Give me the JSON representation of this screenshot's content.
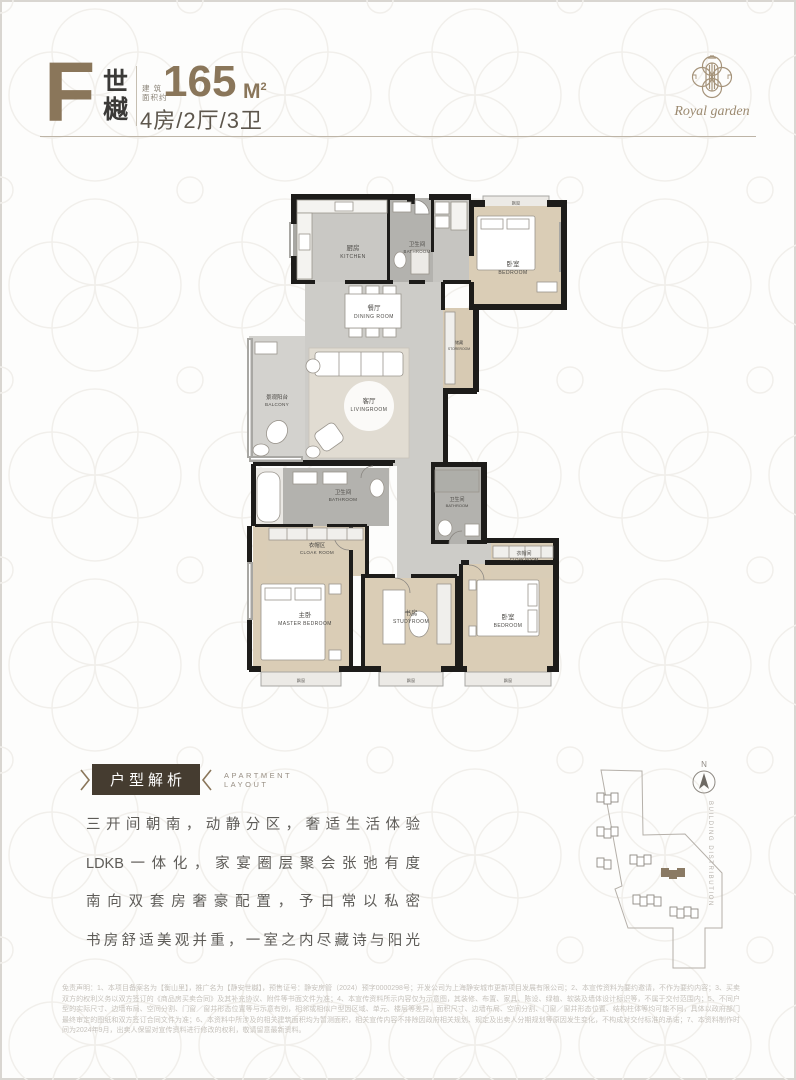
{
  "colors": {
    "accent_brown": "#8a765a",
    "badge_brown": "#453c30",
    "wall_black": "#1d1c1a",
    "floor_gray": "#cdccc8",
    "floor_tan": "#dacdb6",
    "floor_bath": "#b3b2ae",
    "highlight_building": "#8a7a64"
  },
  "header": {
    "unit_letter": "F",
    "unit_name_top": "世",
    "unit_name_bottom": "樾",
    "area_label_line1": "建 筑",
    "area_label_line2": "面积约",
    "area_value": "165",
    "area_unit": "M",
    "area_unit_sup": "2",
    "layout_spec": "4房/2厅/3卫",
    "brand_script": "Royal garden"
  },
  "floorplan": {
    "bay_window_label": "飘窗",
    "rooms": {
      "kitchen": {
        "zh": "厨房",
        "en": "KITCHEN"
      },
      "bathroom_top": {
        "zh": "卫生间",
        "en": "BATHROOM"
      },
      "bedroom_top": {
        "zh": "卧室",
        "en": "BEDROOM"
      },
      "dining": {
        "zh": "餐厅",
        "en": "DINING ROOM"
      },
      "storeroom": {
        "zh": "储藏",
        "en": "STOREROOM"
      },
      "balcony": {
        "zh": "景观阳台",
        "en": "BALCONY"
      },
      "living": {
        "zh": "客厅",
        "en": "LIVINGROOM"
      },
      "bathroom_left": {
        "zh": "卫生间",
        "en": "BATHROOM"
      },
      "cloak_left": {
        "zh": "衣帽区",
        "en": "CLOAK ROOM"
      },
      "bathroom_right": {
        "zh": "卫生间",
        "en": "BATHROOM"
      },
      "cloak_right": {
        "zh": "衣帽间",
        "en": "CLOAK ROOM"
      },
      "master": {
        "zh": "主卧",
        "en": "MASTER BEDROOM"
      },
      "study": {
        "zh": "书房",
        "en": "STUDYROOM"
      },
      "bedroom_br": {
        "zh": "卧室",
        "en": "BEDROOM"
      }
    }
  },
  "analysis": {
    "badge_label": "户型解析",
    "subtitle_line1": "APARTMENT",
    "subtitle_line2": "LAYOUT",
    "paragraph_lines": [
      "三开间朝南，动静分区，奢适生活体验",
      "LDKB一体化，家宴圈层聚会张弛有度",
      "南向双套房奢豪配置，予日常以私密",
      "书房舒适美观并重，一室之内尽藏诗与阳光"
    ]
  },
  "siteplan": {
    "north_label": "N",
    "caption": "BUILDING DISTRIBUTION"
  },
  "disclaimer": {
    "text": "免责声明：1、本项目备案名为【衡山里】，推广名为【静安世樾】，预售证号：静安房管（2024）预字0000298号；开发公司为上海静安城市更新项目发展有限公司；2、本宣传资料为要约邀请，不作为要约内容；3、买卖双方的权利义务以双方签订的《商品房买卖合同》及其补充协议、附件等书面文件为准；4、本宣传资料所示内容仅为示意图，其装修、布置、家具、陈设、绿植、软装及墙体设计标识等，不属于交付范围内；5、不同户型的实际尺寸、边墙布局、空间分割、门窗／窗井形态位置等与示意有别，相邻或相似户型因区域、单元、楼层等差异，面积尺寸、边墙布局、空间分割、门窗／窗井形态位置、结构柱体等均可能不同，具体以政府部门最终审定的图纸和双方签订合同文件为准；6、本资料中所涉及的相关建筑面积均为暂测面积，相关宣传内容不排除因政府相关规划、规定及出卖人分期规划等原因发生变化，不构成对交付标准的承诺；7、本资料制作时间为2024年9月，出卖人保留对宣传资料进行修改的权利，敬请留意最新资料。"
  }
}
